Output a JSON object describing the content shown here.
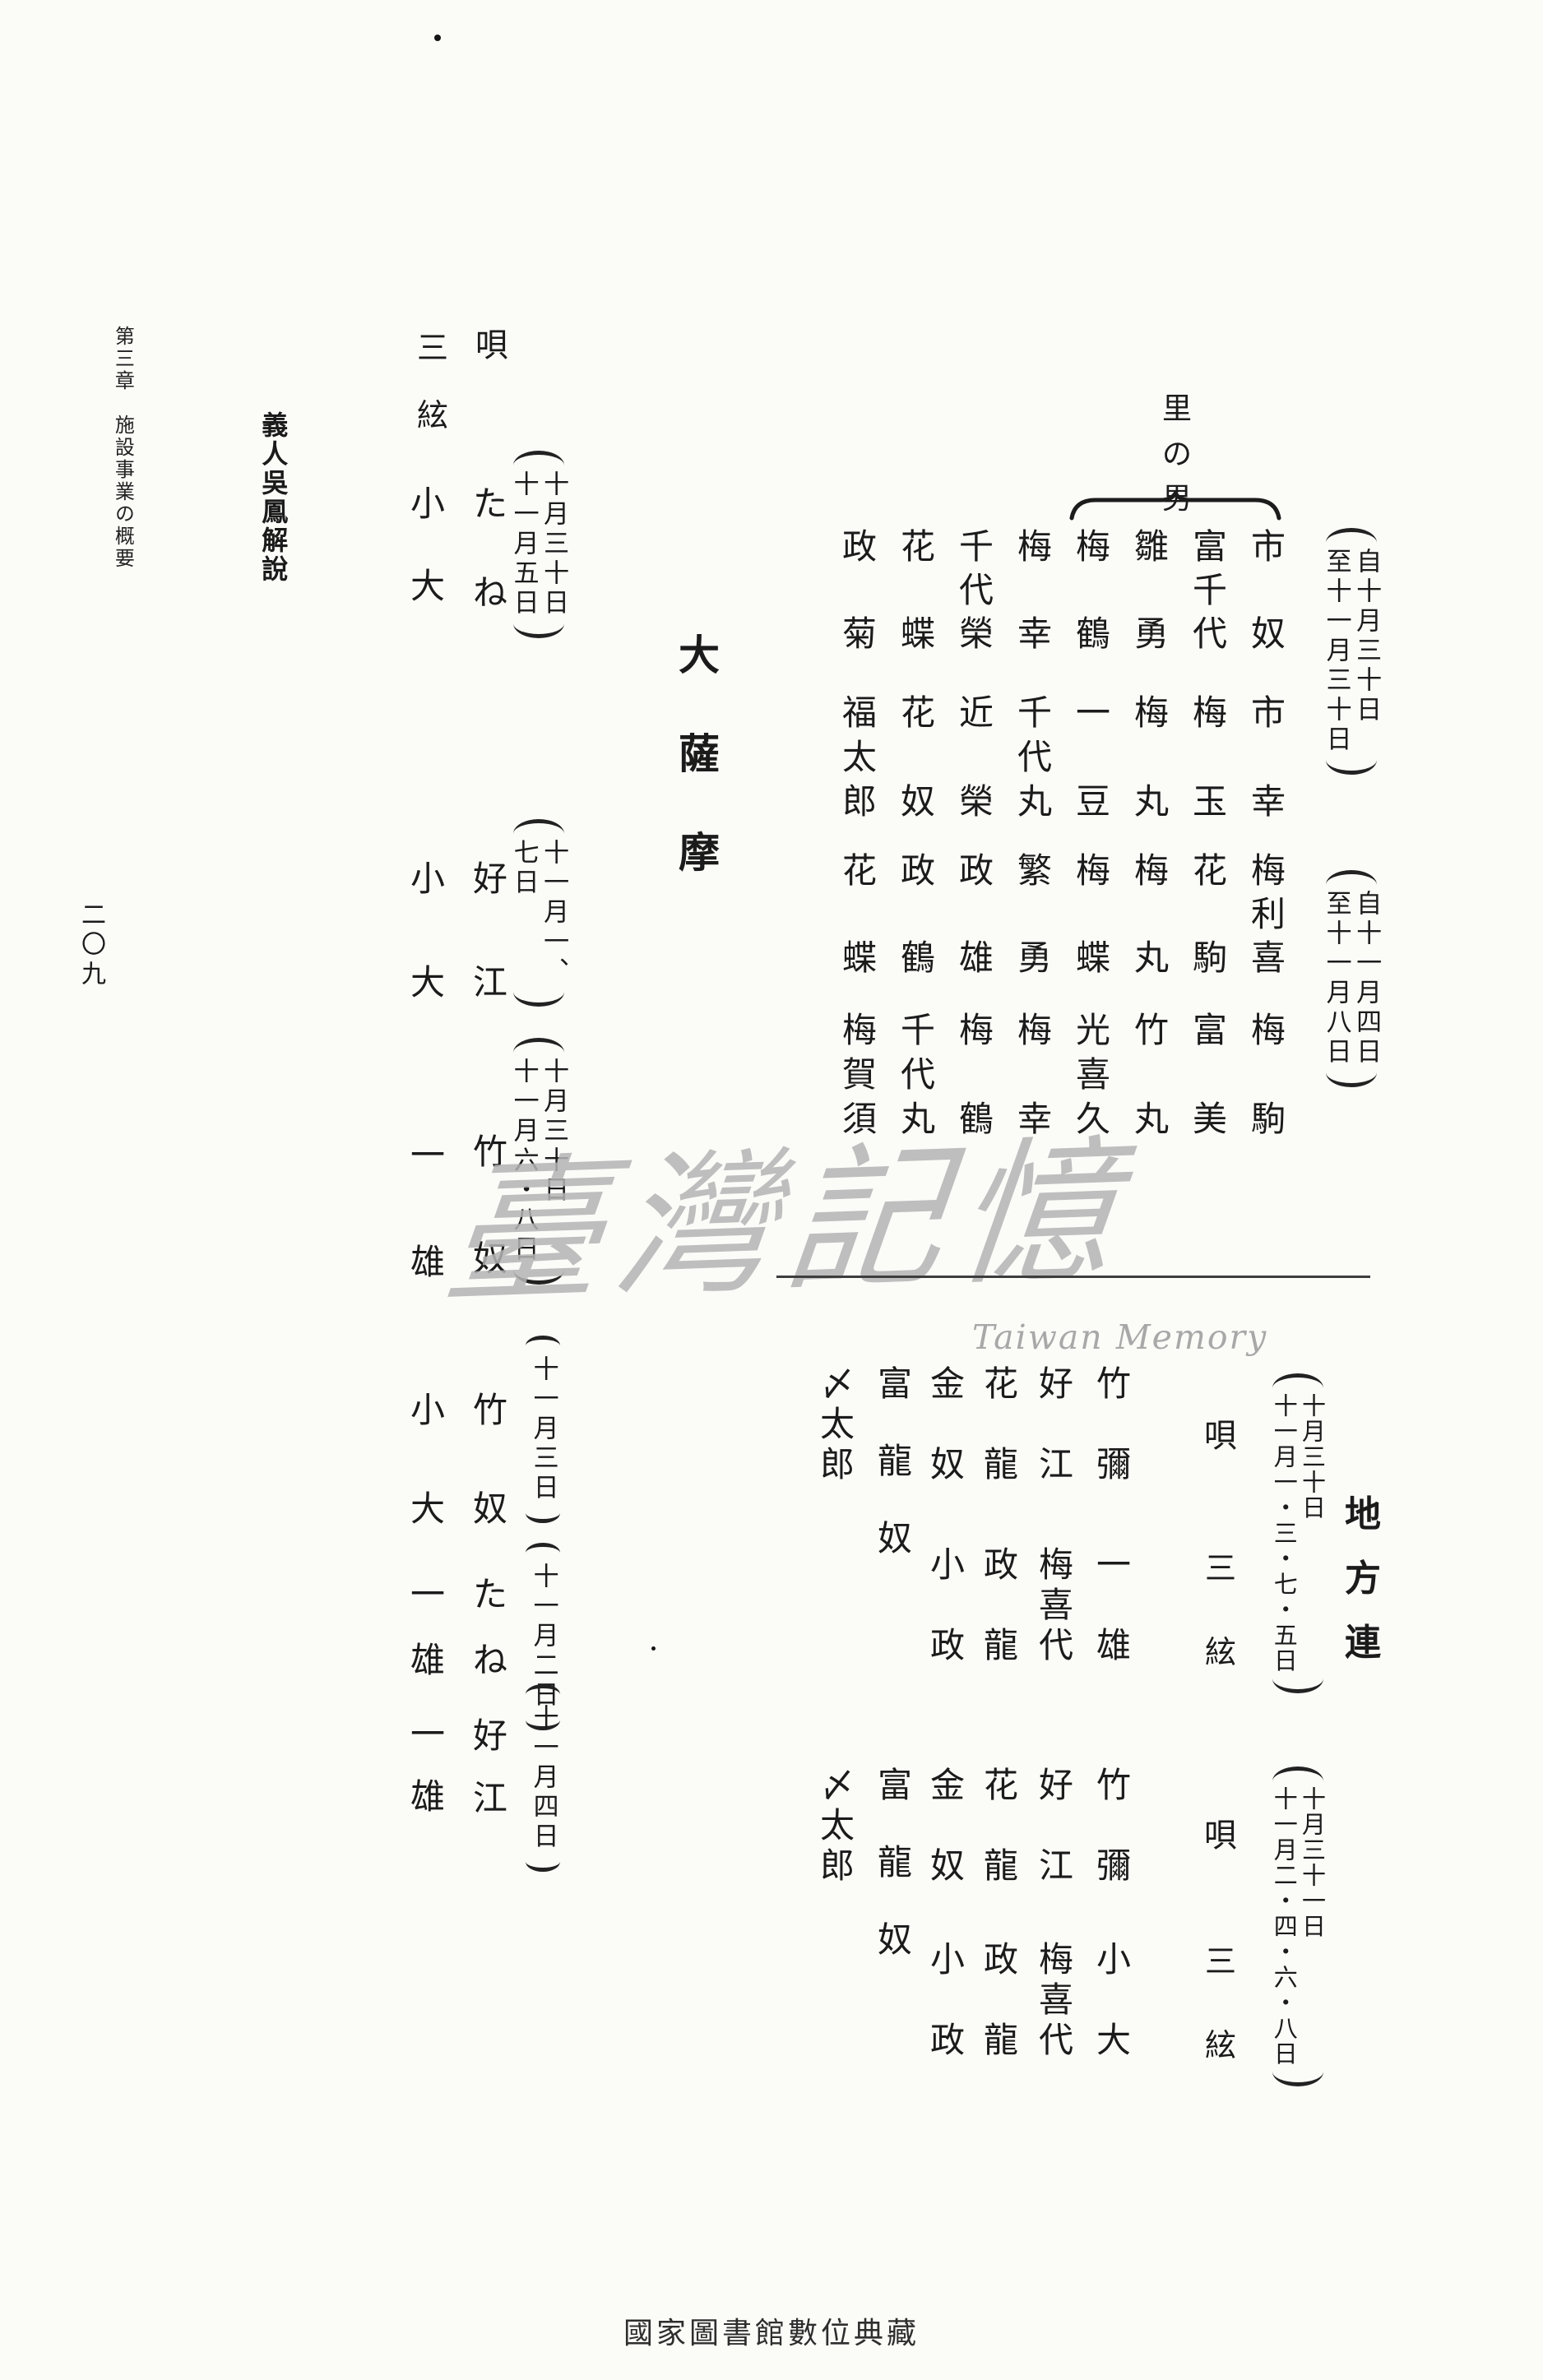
{
  "page": {
    "chapter_header": "第三章　施設事業の概要",
    "section_title": "義人吳鳳解說",
    "page_number": "二〇九",
    "footer": "國家圖書館數位典藏"
  },
  "watermark": {
    "script": "臺灣記憶",
    "latin": "Taiwan Memory"
  },
  "village_block": {
    "group_label": "里の男",
    "date": [
      "自十月三十日",
      "至十一月三十日"
    ],
    "row1": [
      "市奴",
      "富千代",
      "雛勇",
      "梅鶴",
      "梅幸",
      "千代榮",
      "花蝶",
      "政菊"
    ],
    "row2": [
      "市幸",
      "梅玉",
      "梅丸",
      "一豆",
      "千代丸",
      "近榮",
      "花奴",
      "福太郎"
    ]
  },
  "second_block": {
    "date": [
      "自十一月四日",
      "至十一月八日"
    ],
    "row1": [
      "梅利喜",
      "花駒",
      "梅丸",
      "梅蝶",
      "繁勇",
      "政雄",
      "政鶴",
      "花蝶"
    ],
    "row2": [
      "梅駒",
      "富美",
      "竹丸",
      "光喜久",
      "梅幸",
      "梅鶴",
      "千代丸",
      "梅賀須"
    ]
  },
  "daisatsuma": {
    "title": "大薩摩",
    "col_uta": "唄",
    "col_shamisen": "三絃",
    "rows": [
      {
        "uta": "たね",
        "shamisen": "小大",
        "date": [
          "十月三十日",
          "十一月五日"
        ]
      },
      {
        "uta": "好江",
        "shamisen": "小大",
        "date": [
          "十一月一、",
          "七日"
        ]
      },
      {
        "uta": "竹奴",
        "shamisen": "一雄",
        "date": [
          "十月三十日",
          "十一月六・八日"
        ]
      },
      {
        "uta": "竹奴",
        "shamisen": "小大",
        "date": [
          "十一月三日"
        ]
      },
      {
        "uta": "たね",
        "shamisen": "一雄",
        "date": [
          "十一月二日"
        ]
      },
      {
        "uta": "好江",
        "shamisen": "一雄",
        "date": [
          "十一月四日"
        ]
      }
    ]
  },
  "chihoren": {
    "title": "地方連",
    "col_uta": "唄",
    "col_shamisen": "三絃",
    "groups": [
      {
        "date": [
          "十月三十日",
          "十一月一・三・七・五日"
        ],
        "row1": [
          "竹彌",
          "好江",
          "花龍",
          "金奴"
        ],
        "row2": [
          "一雄",
          "梅喜代",
          "政龍",
          "小政"
        ],
        "solo": [
          "富龍奴",
          "〆太郎"
        ]
      },
      {
        "date": [
          "十月三十一日",
          "十一月二・四・六・八日"
        ],
        "row1": [
          "竹彌",
          "好江",
          "花龍",
          "金奴"
        ],
        "row2": [
          "小大",
          "梅喜代",
          "政龍",
          "小政"
        ],
        "solo": [
          "富龍奴",
          "〆太郎"
        ]
      }
    ]
  }
}
